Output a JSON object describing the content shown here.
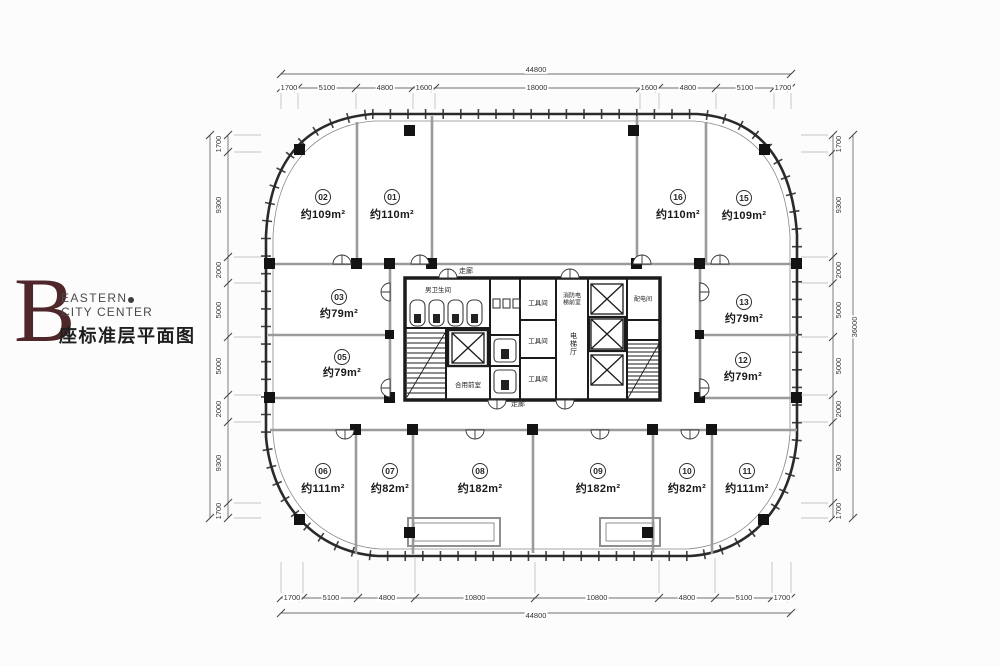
{
  "branding": {
    "letter": "B",
    "line1": "EASTERN",
    "line2": "CITY CENTER",
    "subtitle": "座标准层平面图",
    "accent_color": "#4f272b"
  },
  "rooms": {
    "r01": {
      "unit": "01",
      "area": "约110m²"
    },
    "r02": {
      "unit": "02",
      "area": "约109m²"
    },
    "r03": {
      "unit": "03",
      "area": "约79m²"
    },
    "r05": {
      "unit": "05",
      "area": "约79m²"
    },
    "r06": {
      "unit": "06",
      "area": "约111m²"
    },
    "r07": {
      "unit": "07",
      "area": "约82m²"
    },
    "r08": {
      "unit": "08",
      "area": "约182m²"
    },
    "r09": {
      "unit": "09",
      "area": "约182m²"
    },
    "r10": {
      "unit": "10",
      "area": "约82m²"
    },
    "r11": {
      "unit": "11",
      "area": "约111m²"
    },
    "r12": {
      "unit": "12",
      "area": "约79m²"
    },
    "r13": {
      "unit": "13",
      "area": "约79m²"
    },
    "r15": {
      "unit": "15",
      "area": "约109m²"
    },
    "r16": {
      "unit": "16",
      "area": "约110m²"
    }
  },
  "core": {
    "toilet": "男卫生间",
    "shared_vestibule": "合用前室",
    "tool_room": "工具间",
    "elevator_hall": "电梯厅",
    "fire_elevator_lobby": "消防电梯前室",
    "power_room": "配电间",
    "corridor": "走廊"
  },
  "dimensions": {
    "top": {
      "total": "44800",
      "segments": [
        "1700",
        "5100",
        "4800",
        "1600",
        "18000",
        "1600",
        "4800",
        "5100",
        "1700"
      ]
    },
    "bottom": {
      "total": "44800",
      "segments": [
        "1700",
        "5100",
        "4800",
        "10800",
        "10800",
        "4800",
        "5100",
        "1700"
      ]
    },
    "left": {
      "segments": [
        "1700",
        "9300",
        "2000",
        "5000",
        "5000",
        "2000",
        "9300",
        "1700"
      ]
    },
    "right": {
      "total": "36000",
      "segments": [
        "1700",
        "9300",
        "2000",
        "5000",
        "5000",
        "2000",
        "9300",
        "1700"
      ]
    }
  },
  "colors": {
    "brand": "#4f272b",
    "facade": "#2a2a2a",
    "interior_wall": "#9b9b9b",
    "core_wall": "#1b1b1b",
    "dimension_line": "#6e6e6e"
  }
}
